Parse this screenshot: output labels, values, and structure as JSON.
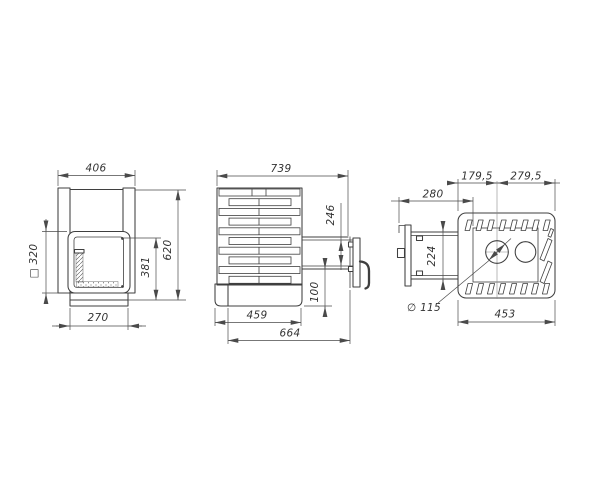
{
  "meta": {
    "drawing_type": "three-view dimensional drawing",
    "units": "mm"
  },
  "colors": {
    "background": "#ffffff",
    "line": "#3f3f3f",
    "dimension_line": "#4a4a4a",
    "text": "#333333"
  },
  "views": {
    "front": {
      "dims": {
        "overall_width": "406",
        "firebox_square": "□ 320",
        "glass_height": "381",
        "overall_height": "620",
        "base_width": "270"
      }
    },
    "side": {
      "dims": {
        "overall_depth": "739",
        "door_opening_height": "246",
        "door_bottom_height": "100",
        "body_depth": "459",
        "depth_with_door": "664"
      }
    },
    "top": {
      "dims": {
        "center_offset_left": "179,5",
        "center_offset_right": "279,5",
        "tunnel_length": "280",
        "tunnel_width": "224",
        "flue_diameter": "∅ 115",
        "body_width": "453"
      }
    }
  }
}
